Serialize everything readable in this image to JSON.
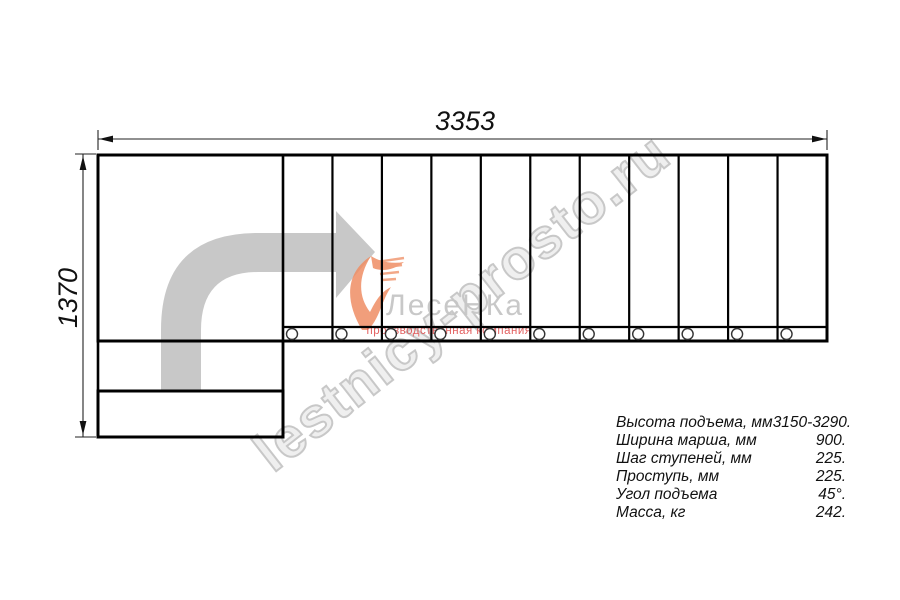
{
  "drawing": {
    "width_dim": "3353",
    "height_dim": "1370",
    "tread_count": 11,
    "bolt_count": 11
  },
  "watermark": {
    "site": "lestnicy-prosto.ru",
    "logo_name": "ЛесеНКа",
    "logo_tagline": "производственная компания"
  },
  "specs": {
    "rows": [
      {
        "label": "Высота подъема, мм",
        "value": "3150-3290."
      },
      {
        "label": "Ширина марша, мм",
        "value": "900."
      },
      {
        "label": "Шаг ступеней, мм",
        "value": "225."
      },
      {
        "label": "Проступь, мм",
        "value": "225."
      },
      {
        "label": "Угол подъема",
        "value": "45°."
      },
      {
        "label": "Масса, кг",
        "value": "242."
      }
    ]
  },
  "colors": {
    "arrow_gray": "#c8c8c8",
    "logo_orange": "#EF8E64",
    "logo_text_gray": "#C6C6C6",
    "tagline_red": "#E05050",
    "watermark_gray": "#B4B4B4",
    "line_black": "#000000"
  }
}
